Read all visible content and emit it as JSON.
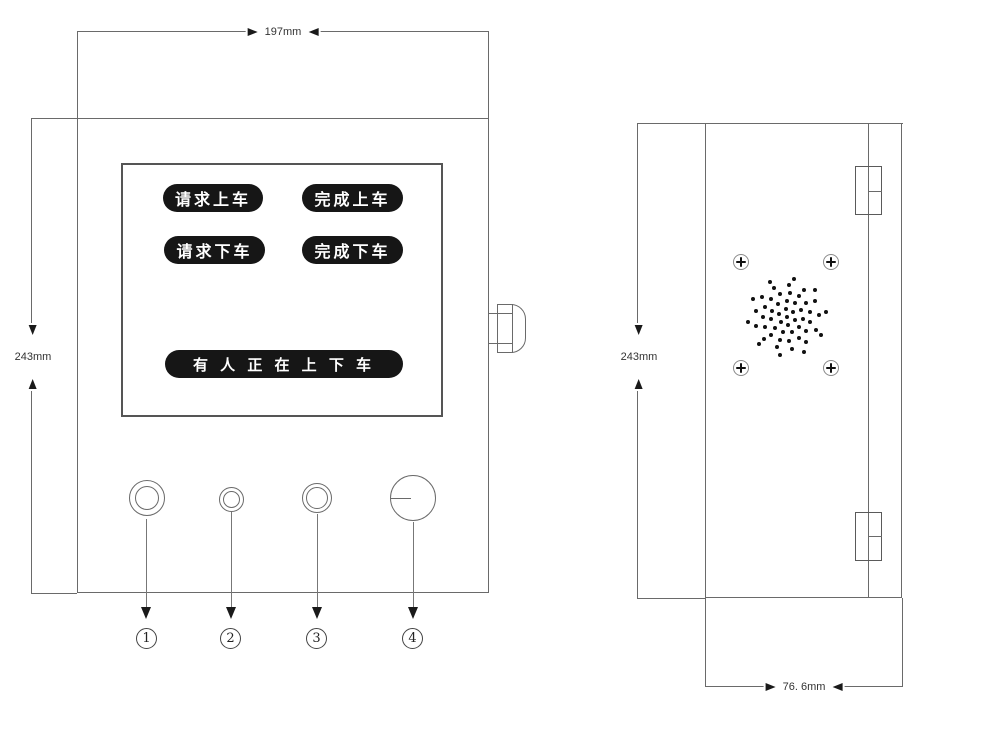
{
  "front_view": {
    "width_dim": "197mm",
    "height_dim": "243mm",
    "screen_buttons": [
      {
        "label": "请求上车"
      },
      {
        "label": "完成上车"
      },
      {
        "label": "请求下车"
      },
      {
        "label": "完成下车"
      }
    ],
    "status_banner": "有 人 正 在 上 下 车",
    "callouts": [
      {
        "num": "1"
      },
      {
        "num": "2"
      },
      {
        "num": "3"
      },
      {
        "num": "4"
      }
    ]
  },
  "side_view": {
    "height_dim": "243mm",
    "depth_dim": "76. 6mm",
    "speaker": {
      "dot": 4,
      "rings": [
        {
          "r": 0,
          "n": 1
        },
        {
          "r": 8,
          "n": 6
        },
        {
          "r": 16,
          "n": 11
        },
        {
          "r": 24,
          "n": 15
        },
        {
          "r": 32,
          "n": 13
        },
        {
          "r": 39,
          "n": 10
        }
      ]
    }
  },
  "colors": {
    "line": "#6a6a6a",
    "button_bg": "#161616",
    "button_text": "#ffffff",
    "dim_text": "#333333"
  }
}
